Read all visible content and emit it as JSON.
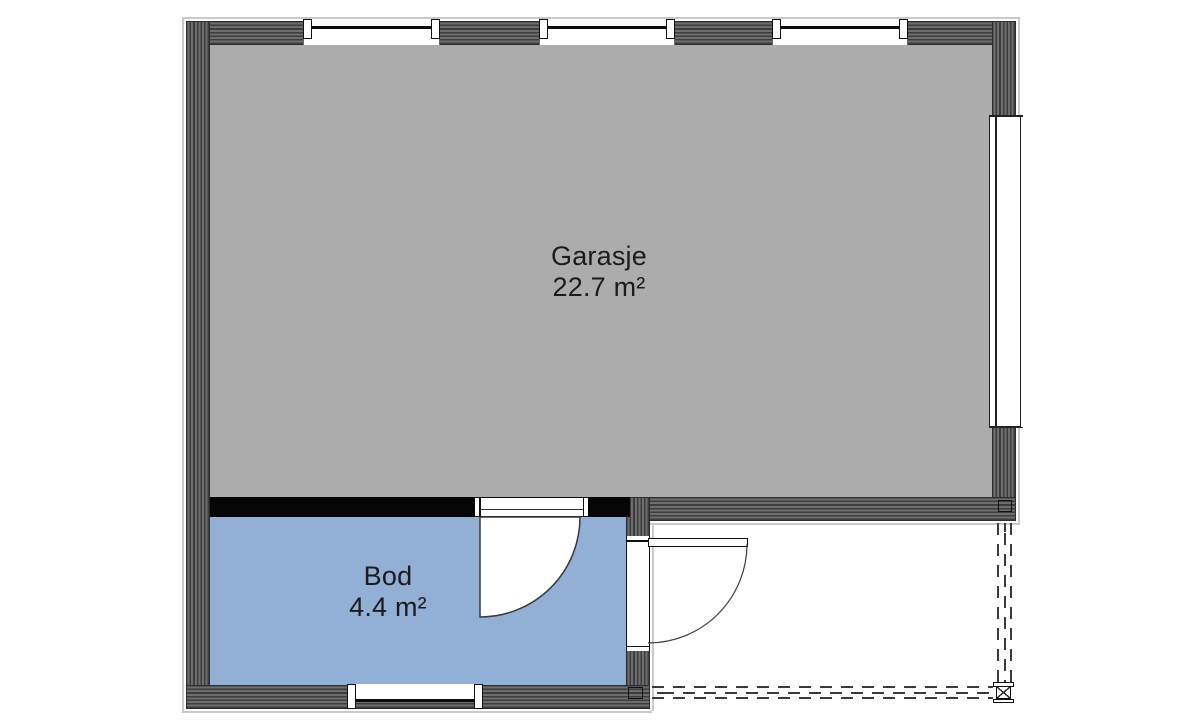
{
  "page": {
    "type": "floor-plan"
  },
  "rooms": [
    {
      "name": "Garasje",
      "area": "22.7 m²"
    },
    {
      "name": "Bod",
      "area": "4.4 m²"
    }
  ],
  "symbols": {
    "windows": [
      "top-window-1",
      "top-window-2",
      "top-window-3",
      "right-wall-window",
      "bottom-window"
    ],
    "doors": [
      "bod-interior-door",
      "bod-exterior-door"
    ],
    "post": "support-post",
    "dashed_outline": "roof-overhang-outline"
  },
  "colors": {
    "page_bg": "#ffffff",
    "garage_floor": "#acacac",
    "bod_floor": "#92afd6",
    "wall_dark": "#3d3d3d",
    "wall_light": "#6e6e6e",
    "interior_wall": "#060606",
    "outline_light": "#c9c9c9",
    "text": "#1b1b1b"
  }
}
